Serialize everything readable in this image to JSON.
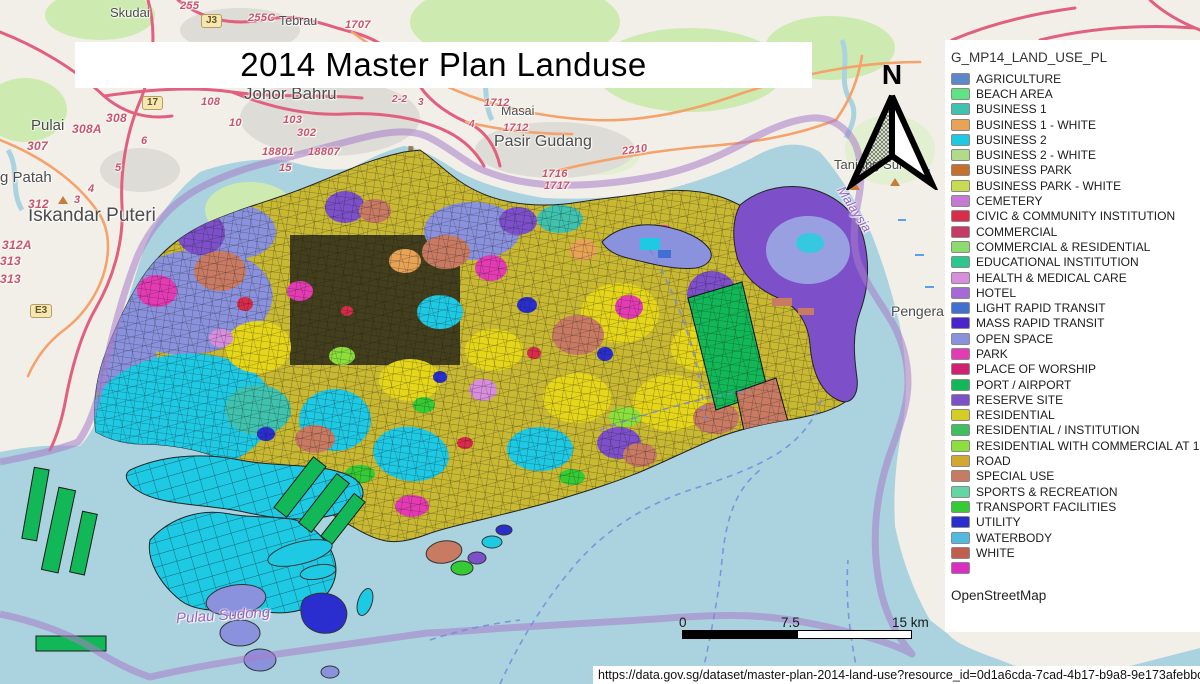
{
  "title": "2014 Master Plan Landuse",
  "north_label": "N",
  "scale_bar": {
    "start": "0",
    "mid": "7.5",
    "end": "15 km"
  },
  "source_url": "https://data.gov.sg/dataset/master-plan-2014-land-use?resource_id=0d1a6cda-7cad-4b17-b9a8-9e173afebbc1",
  "legend": {
    "heading": "G_MP14_LAND_USE_PL",
    "attribution": "OpenStreetMap",
    "items": [
      {
        "label": "AGRICULTURE",
        "color": "#5c87c9"
      },
      {
        "label": "BEACH AREA",
        "color": "#5fe483"
      },
      {
        "label": "BUSINESS 1",
        "color": "#3fc2ae"
      },
      {
        "label": "BUSINESS 1 - WHITE",
        "color": "#e8a355"
      },
      {
        "label": "BUSINESS 2",
        "color": "#1ec9e4"
      },
      {
        "label": "BUSINESS 2 - WHITE",
        "color": "#b1db8b"
      },
      {
        "label": "BUSINESS PARK",
        "color": "#c4712d"
      },
      {
        "label": "BUSINESS PARK - WHITE",
        "color": "#c9db50"
      },
      {
        "label": "CEMETERY",
        "color": "#c77ad5"
      },
      {
        "label": "CIVIC & COMMUNITY INSTITUTION",
        "color": "#d92b4a"
      },
      {
        "label": "COMMERCIAL",
        "color": "#c63a65"
      },
      {
        "label": "COMMERCIAL & RESIDENTIAL",
        "color": "#8cdb70"
      },
      {
        "label": "EDUCATIONAL INSTITUTION",
        "color": "#2ac78f"
      },
      {
        "label": "HEALTH & MEDICAL CARE",
        "color": "#d88ddd"
      },
      {
        "label": "HOTEL",
        "color": "#a56ad5"
      },
      {
        "label": "LIGHT RAPID TRANSIT",
        "color": "#4270d2"
      },
      {
        "label": "MASS RAPID TRANSIT",
        "color": "#4a25cc"
      },
      {
        "label": "OPEN SPACE",
        "color": "#8a92dd"
      },
      {
        "label": "PARK",
        "color": "#e43bb4"
      },
      {
        "label": "PLACE OF WORSHIP",
        "color": "#d02270"
      },
      {
        "label": "PORT / AIRPORT",
        "color": "#12b857"
      },
      {
        "label": "RESERVE SITE",
        "color": "#7d50ca"
      },
      {
        "label": "RESIDENTIAL",
        "color": "#d5cd25"
      },
      {
        "label": "RESIDENTIAL / INSTITUTION",
        "color": "#3ebf62"
      },
      {
        "label": "RESIDENTIAL WITH COMMERCIAL AT 1ST",
        "color": "#8ce03c"
      },
      {
        "label": "ROAD",
        "color": "#d2a830"
      },
      {
        "label": "SPECIAL USE",
        "color": "#c87b62"
      },
      {
        "label": "SPORTS & RECREATION",
        "color": "#62d7a4"
      },
      {
        "label": "TRANSPORT FACILITIES",
        "color": "#34cb34"
      },
      {
        "label": "UTILITY",
        "color": "#2a2ecf"
      },
      {
        "label": "WATERBODY",
        "color": "#53badf"
      },
      {
        "label": "WHITE",
        "color": "#c15f4e"
      },
      {
        "label": "",
        "color": "#dc2fc1"
      }
    ]
  },
  "map": {
    "places": [
      "Skudai",
      "Tebrau",
      "Johor Bahru",
      "Masai",
      "Pasir Gudang",
      "Pulai",
      "g Patah",
      "Iskandar Puteri",
      "Tanjung Sur",
      "Pengera"
    ],
    "waters": [
      "Malaysia",
      "Pulau Sudong"
    ],
    "refs": [
      "255",
      "255C",
      "1707",
      "308",
      "308A",
      "307",
      "108",
      "10",
      "103",
      "302",
      "18801",
      "18807",
      "15",
      "2-2",
      "3",
      "4",
      "6",
      "5",
      "4",
      "3",
      "312",
      "312A",
      "313",
      "313",
      "1712",
      "1712",
      "1716",
      "1717",
      "2210"
    ],
    "badges": [
      "J3",
      "17",
      "E3"
    ]
  }
}
